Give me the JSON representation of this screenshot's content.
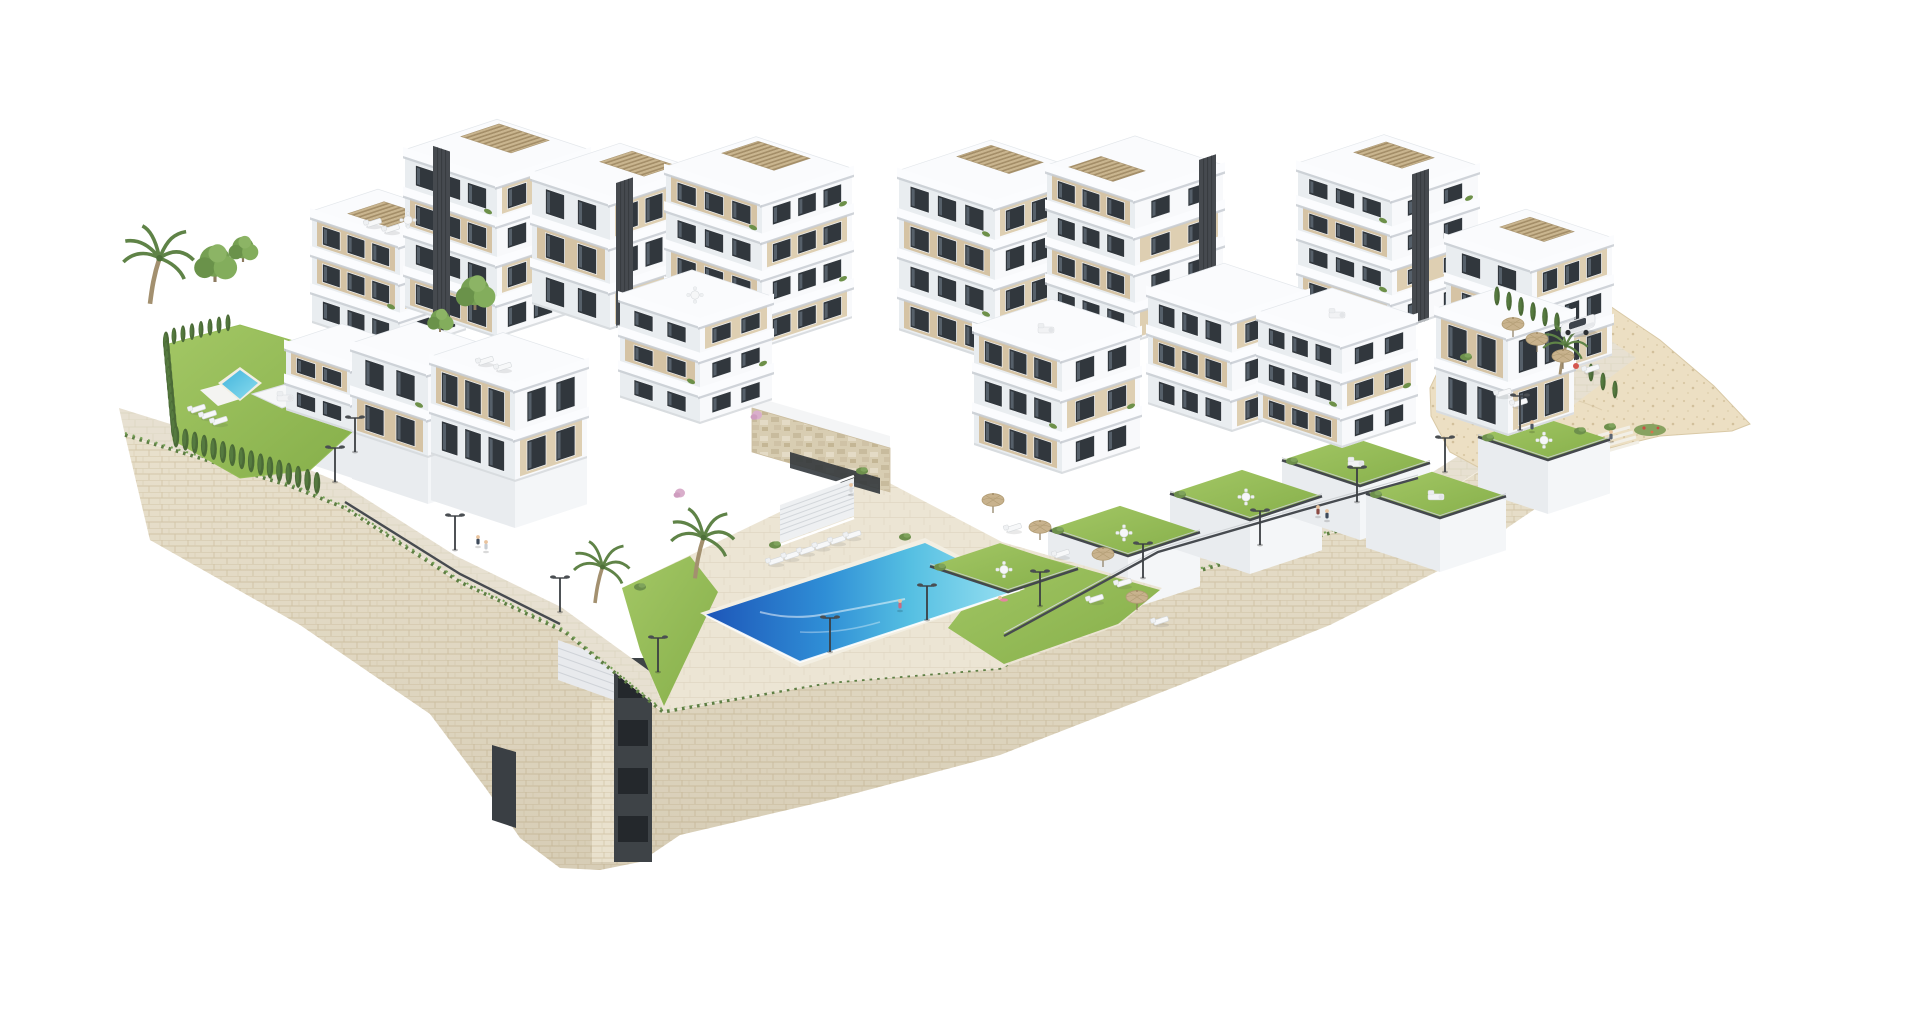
{
  "scene": {
    "title": "New-build residential complex - aerial 3D visualization",
    "description": "Isometric architectural rendering of a terraced white apartment complex on a hillside plot, with three swimming pools, landscaped gardens, rooftop pergolas, a promenade with street lamps and a curved natural-stone retaining wall, on a plain white background.",
    "view": "high-angle isometric",
    "background_color": "#ffffff"
  },
  "palette": {
    "building_white": "#f8f9fb",
    "building_shadow": "#e9edf0",
    "facade_beige": "#d5c3a4",
    "window_glass": "#31373d",
    "elevator_shaft": "#464a4f",
    "pergola_wood": "#c9b58f",
    "stone_wall": "#e9e1cd",
    "pavement": "#e7e0d1",
    "rock_sand": "#ecdfc3",
    "lawn_green": "#96bd58",
    "hedge_green": "#4b6a37",
    "pool_deep": "#1d55b8",
    "pool_mid": "#2f8ed6",
    "pool_aqua": "#55bfe2",
    "pool_light": "#9ce2f2",
    "umbrella_beige": "#c8b28d",
    "car_white": "#f3f4f6"
  },
  "inventory": {
    "apartment_blocks": 16,
    "floors_range": "2 to 5",
    "swimming_pools": [
      {
        "name": "main communal pool",
        "shape": "rectangular with infinity edge",
        "water": "deep blue to turquoise"
      },
      {
        "name": "secondary communal pool",
        "shape": "rectangular",
        "water": "turquoise"
      },
      {
        "name": "private plunge pool",
        "shape": "rectangular",
        "water": "turquoise"
      }
    ],
    "sun_loungers": 20,
    "parasols": 7,
    "rooftop_pergolas": 8,
    "street_lamps": 13,
    "people": 9,
    "vehicles": [
      {
        "type": "SUV",
        "color": "white"
      }
    ],
    "vegetation": {
      "palm_trees": 4,
      "leafy_trees": 4,
      "cypress_hedges": 3,
      "garden_shrubs": "numerous"
    },
    "site_features": [
      "curved stone retaining walls",
      "promenade",
      "terraced private gardens",
      "central entrance staircase",
      "travertine feature wall",
      "rocky terrain at east end",
      "stair tower through wall"
    ]
  }
}
